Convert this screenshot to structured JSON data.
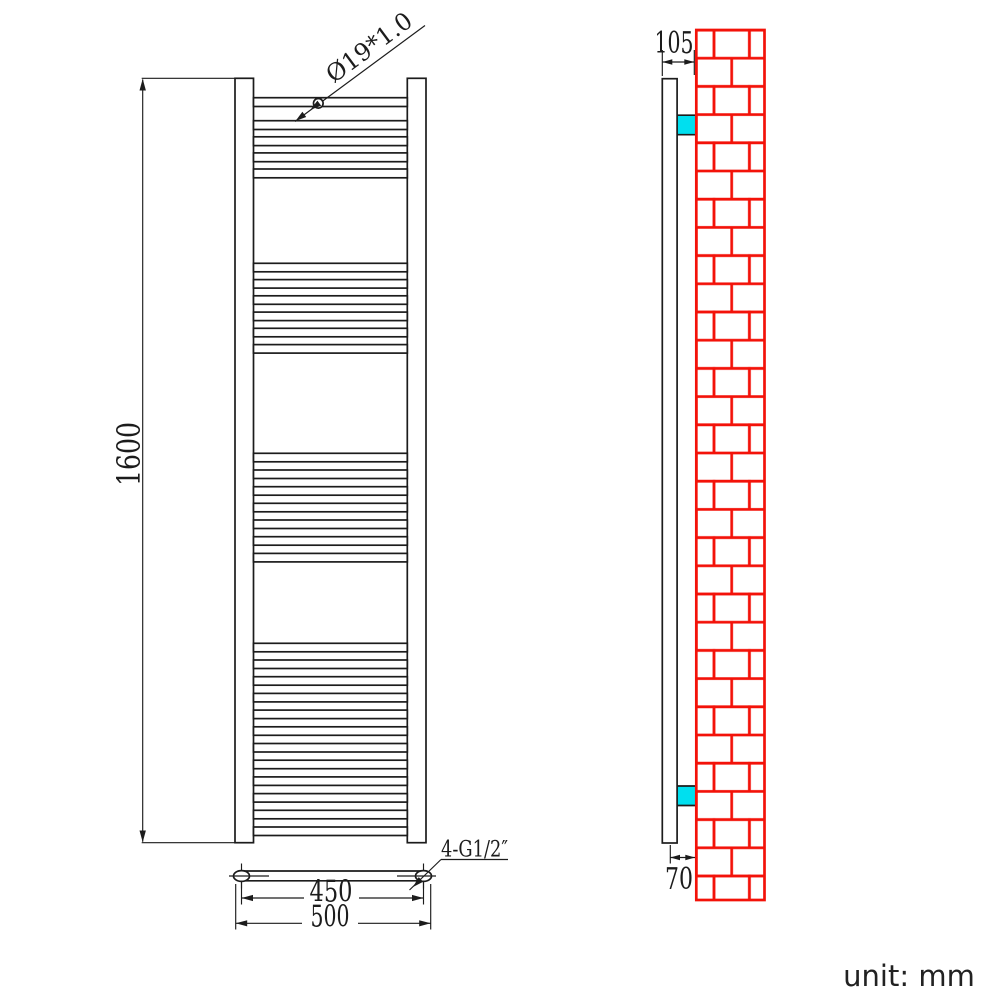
{
  "labels": {
    "height": "1600",
    "tube_diameter": "Ø19*1.0",
    "inlet_spacing": "450",
    "overall_width": "500",
    "thread_spec": "4-G1/2″",
    "depth_overall": "105",
    "depth_bottom": "70",
    "unit_note": "unit: mm"
  },
  "colors": {
    "ink": "#1c1c1c",
    "brick_red": "#f31209",
    "bracket_cyan": "#00dfef",
    "background": "#ffffff"
  },
  "front_view": {
    "tube_x": 253.5,
    "tube_width": 153.8,
    "tube_groups": [
      {
        "start": 97.7,
        "count": 1,
        "pitch": 23.0,
        "height": 8.8
      },
      {
        "start": 120.7,
        "count": 4,
        "pitch": 16.1,
        "height": 8.8
      },
      {
        "start": 263.3,
        "count": 6,
        "pitch": 16.25,
        "height": 8.5
      },
      {
        "start": 453.3,
        "count": 7,
        "pitch": 16.68,
        "height": 8.5
      },
      {
        "start": 643.3,
        "count": 12,
        "pitch": 16.7,
        "height": 8.5
      }
    ]
  },
  "side_view": {
    "bracket_x": 677.2,
    "bracket_width": 18.8,
    "bracket_height": 19.5,
    "brackets_y": [
      115.2,
      786.0
    ]
  }
}
